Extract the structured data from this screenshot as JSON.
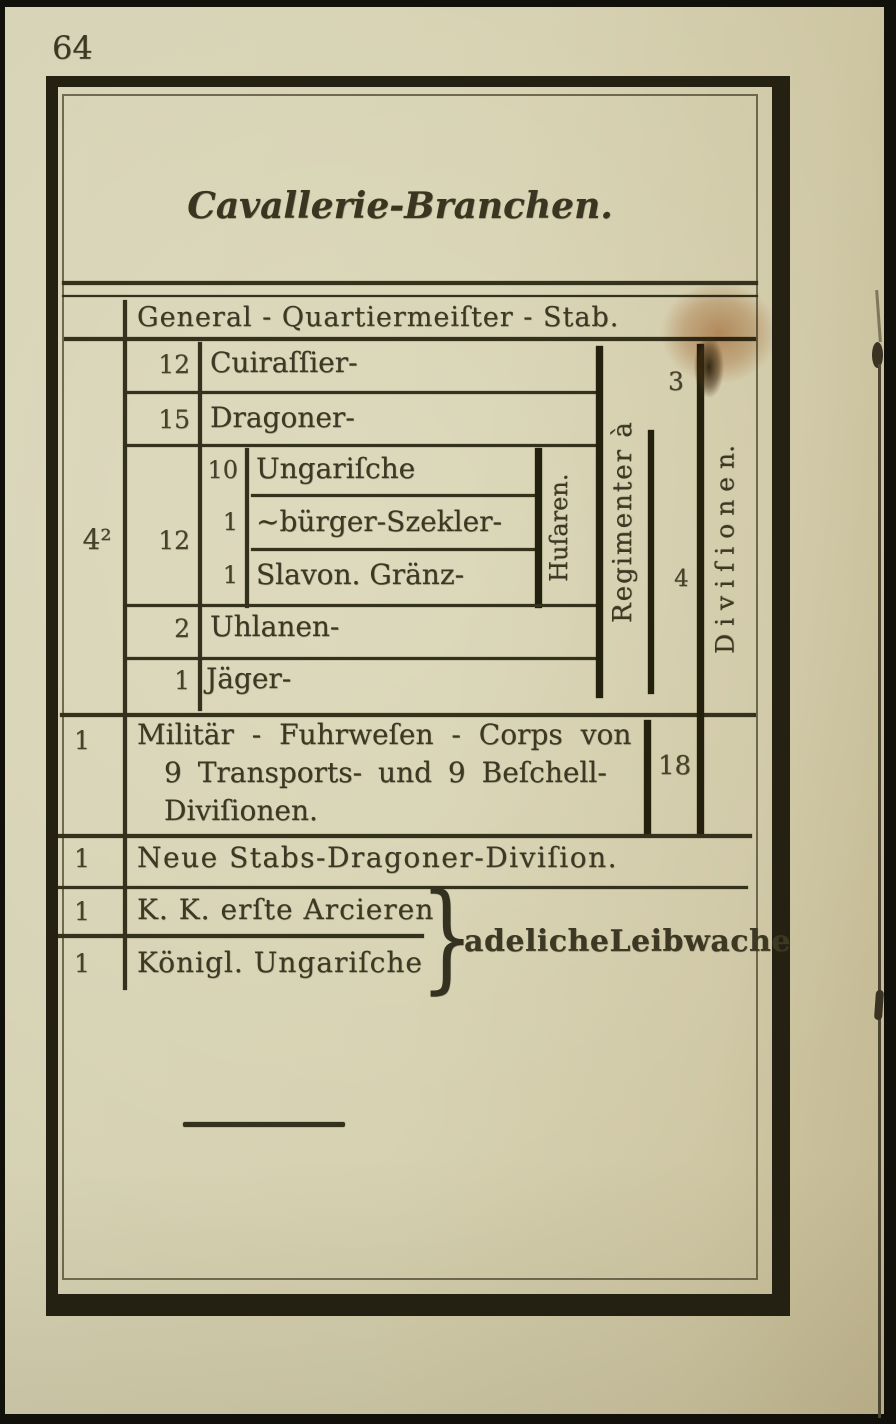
{
  "page_number": "64",
  "title": "Cavallerie-Branchen.",
  "table": {
    "header_row": "General - Quartiermeiſter - Stab.",
    "total_count": "4²",
    "cuirassier_row": {
      "count": "12",
      "label": "Cuiraſſier-"
    },
    "dragoner_row": {
      "count": "15",
      "label": "Dragoner-"
    },
    "husaren_group": {
      "count": "12",
      "bracket_label": "Huſaren.",
      "subrows": [
        {
          "count": "10",
          "label": "Ungariſche"
        },
        {
          "count": "1",
          "label": "~bürger-Szekler-"
        },
        {
          "count": "1",
          "label": "Slavon. Gränz-"
        }
      ]
    },
    "uhlanen_row": {
      "count": "2",
      "label": "Uhlanen-"
    },
    "jaeger_row": {
      "count": "1",
      "label": "Jäger-"
    },
    "regimenter_column_label": "Regimenter à",
    "regimenter_counts": {
      "heavy": "3",
      "light": "4"
    },
    "divisionen_column_label": "D i v i ſ i o n e n.",
    "fuhrwesen_row": {
      "count": "1",
      "line1": "Militär - Fuhrweſen - Corps von",
      "line2": "9 Transports- und 9 Beſchell-",
      "line3": "Diviſionen.",
      "divisions_count": "18"
    },
    "stabs_row": {
      "count": "1",
      "label": "Neue Stabs-Dragoner-Diviſion."
    },
    "leibwache_rows": {
      "row1": {
        "count": "1",
        "label": "K. K. erſte Arcieren"
      },
      "row2": {
        "count": "1",
        "label": "Königl. Ungariſche"
      },
      "brace": "}",
      "shared_label": "adelicheLeibwache"
    }
  },
  "colors": {
    "paper": "#d5d0b0",
    "ink": "#3c3824",
    "rule": "#34311c",
    "frame": "#242112",
    "stain": "#b87a4c"
  }
}
